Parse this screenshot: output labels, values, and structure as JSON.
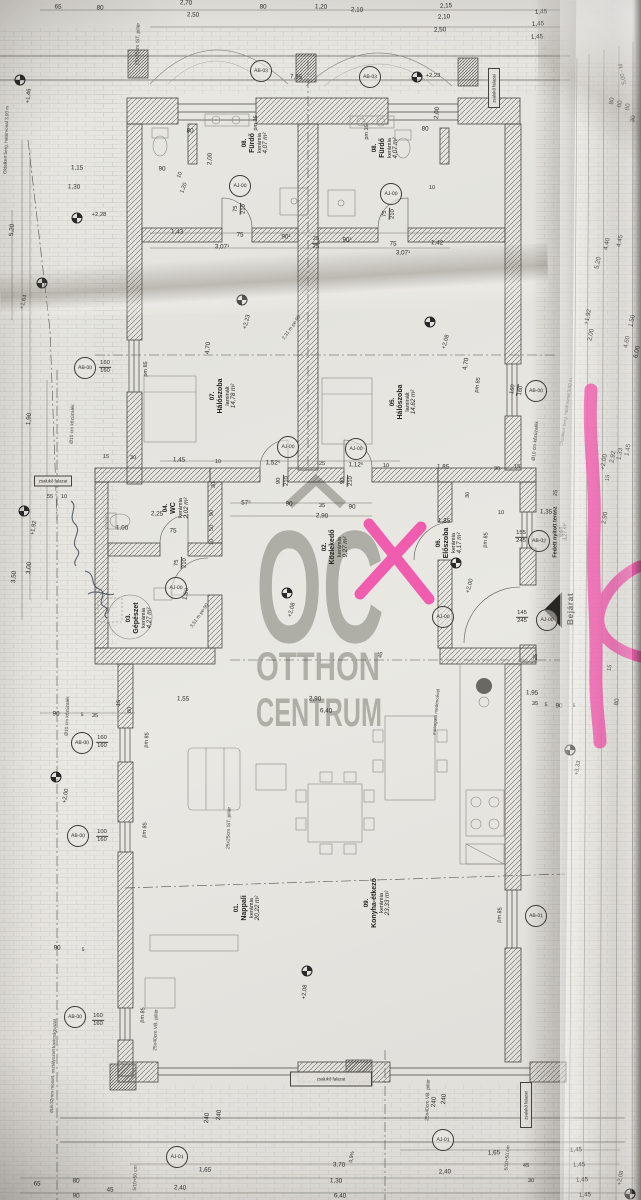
{
  "watermark": {
    "word": "OC",
    "line2": "OTTHON",
    "line3": "CENTRUM",
    "color": "#86867f",
    "roof": "roof-icon"
  },
  "marker": {
    "color": "#f23fa4"
  },
  "pen": {
    "color": "#39414f"
  },
  "entrance": {
    "label": "Bejárat"
  },
  "rooms": [
    {
      "num": "08.",
      "name": "Fürdő",
      "fin": "kerámia",
      "area": "4,07 m²",
      "x": 256,
      "y": 143
    },
    {
      "num": "08.",
      "name": "Fürdő",
      "fin": "kerámia",
      "area": "4,07 m²",
      "x": 386,
      "y": 148
    },
    {
      "num": "07.",
      "name": "Hálószoba",
      "fin": "laminált",
      "area": "14,78 m²",
      "x": 224,
      "y": 396
    },
    {
      "num": "05.",
      "name": "Hálószoba",
      "fin": "laminált",
      "area": "14,62 m²",
      "x": 404,
      "y": 402
    },
    {
      "num": "04.",
      "name": "WC",
      "fin": "kerámia",
      "area": "2,02 m²",
      "x": 177,
      "y": 508
    },
    {
      "num": "03.",
      "name": "Gépészet",
      "fin": "kerámia",
      "area": "4,27 m²",
      "x": 140,
      "y": 618
    },
    {
      "num": "02.",
      "name": "Közlekedő",
      "fin": "kerámia",
      "area": "9,27 m²",
      "x": 336,
      "y": 547
    },
    {
      "num": "06.",
      "name": "Előszoba",
      "fin": "kerámia",
      "area": "4,17 m²",
      "x": 450,
      "y": 543
    },
    {
      "num": "01.",
      "name": "Nappali",
      "fin": "kerámia",
      "area": "20,22 m²",
      "x": 248,
      "y": 908
    },
    {
      "num": "09.",
      "name": "Konyha-étkező",
      "fin": "kerámia",
      "area": "23,33 m²",
      "x": 378,
      "y": 903
    },
    {
      "num": "",
      "name": "Fedett nyitott terasz",
      "fin": "térkő",
      "area": "3,27 m²",
      "x": 561,
      "y": 532,
      "small": true
    }
  ],
  "tags": [
    {
      "t": "AB-03",
      "x": 261,
      "y": 71
    },
    {
      "t": "AB-03",
      "x": 370,
      "y": 77
    },
    {
      "t": "AJ-00",
      "x": 240,
      "y": 186
    },
    {
      "t": "AJ-00",
      "x": 391,
      "y": 194
    },
    {
      "t": "AB-00",
      "x": 85,
      "y": 368
    },
    {
      "t": "AJ-00",
      "x": 288,
      "y": 447
    },
    {
      "t": "AJ-00",
      "x": 356,
      "y": 449
    },
    {
      "t": "AJ-00",
      "x": 176,
      "y": 588
    },
    {
      "t": "AB-00",
      "x": 536,
      "y": 391
    },
    {
      "t": "AB-02",
      "x": 539,
      "y": 541
    },
    {
      "t": "AJ-00",
      "x": 443,
      "y": 617
    },
    {
      "t": "AJ-00",
      "x": 547,
      "y": 620
    },
    {
      "t": "AB-00",
      "x": 82,
      "y": 743
    },
    {
      "t": "AB-00",
      "x": 78,
      "y": 836
    },
    {
      "t": "AB-00",
      "x": 75,
      "y": 1017
    },
    {
      "t": "AB-01",
      "x": 536,
      "y": 916
    },
    {
      "t": "AJ-01",
      "x": 177,
      "y": 1157
    },
    {
      "t": "AJ-01",
      "x": 443,
      "y": 1140
    }
  ],
  "stacks": [
    {
      "a": "160",
      "b": "160",
      "x": 105,
      "y": 367
    },
    {
      "a": "160",
      "b": "160",
      "x": 102,
      "y": 742
    },
    {
      "a": "100",
      "b": "160",
      "x": 102,
      "y": 836
    },
    {
      "a": "160",
      "b": "160",
      "x": 98,
      "y": 1020
    },
    {
      "a": "160",
      "b": "160",
      "x": 517,
      "y": 390,
      "r": -80
    },
    {
      "a": "75",
      "b": "210",
      "x": 240,
      "y": 209,
      "r": -88
    },
    {
      "a": "75",
      "b": "210",
      "x": 389,
      "y": 214,
      "r": -88
    },
    {
      "a": "90",
      "b": "210",
      "x": 283,
      "y": 481,
      "r": -88
    },
    {
      "a": "90",
      "b": "210",
      "x": 347,
      "y": 481,
      "r": -88
    },
    {
      "a": "75",
      "b": "210",
      "x": 181,
      "y": 563,
      "r": -88
    },
    {
      "a": "25",
      "b": "25",
      "x": 316,
      "y": 243
    },
    {
      "a": "155",
      "b": "245",
      "x": 521,
      "y": 537
    },
    {
      "a": "145",
      "b": "245",
      "x": 522,
      "y": 617
    }
  ],
  "levels": [
    {
      "t": "+2,23",
      "x": 417,
      "y": 77,
      "tx": 433,
      "ty": 76,
      "r": 0
    },
    {
      "t": "+2,28",
      "x": 77,
      "y": 218,
      "tx": 99,
      "ty": 215,
      "r": 0
    },
    {
      "t": "+1,46",
      "x": 20,
      "y": 80,
      "tx": 29,
      "ty": 96,
      "r": -85
    },
    {
      "t": "+1,64",
      "x": 42,
      "y": 283,
      "tx": 24,
      "ty": 302,
      "r": -75
    },
    {
      "t": "+2,23",
      "x": 242,
      "y": 300,
      "tx": 247,
      "ty": 322,
      "r": -75
    },
    {
      "t": "+2,08",
      "x": 430,
      "y": 322,
      "tx": 446,
      "ty": 342,
      "r": -75
    },
    {
      "t": "+2,08",
      "x": 287,
      "y": 593,
      "tx": 292,
      "ty": 610,
      "r": -75
    },
    {
      "t": "+2,00",
      "x": 456,
      "y": 563,
      "tx": 470,
      "ty": 586,
      "r": -75
    },
    {
      "t": "+1,92",
      "x": 24,
      "y": 511,
      "tx": 34,
      "ty": 528,
      "r": -80
    },
    {
      "t": "+2,00",
      "x": 56,
      "y": 777,
      "tx": 66,
      "ty": 796,
      "r": -80
    },
    {
      "t": "+2,08",
      "x": 307,
      "y": 971,
      "tx": 305,
      "ty": 992,
      "r": -85
    },
    {
      "t": "+3,33",
      "x": 570,
      "y": 750,
      "tx": 578,
      "ty": 768,
      "r": -80
    },
    {
      "t": "+2,08",
      "x": 630,
      "y": 1194,
      "tx": 621,
      "ty": 1178,
      "r": -80
    }
  ],
  "dims": [
    {
      "t": "2,70",
      "x": 186,
      "y": 3
    },
    {
      "t": "65",
      "x": 58,
      "y": 7
    },
    {
      "t": "80",
      "x": 100,
      "y": 8
    },
    {
      "t": "2,50",
      "x": 193,
      "y": 15
    },
    {
      "t": "80",
      "x": 263,
      "y": 7
    },
    {
      "t": "1,20",
      "x": 321,
      "y": 7
    },
    {
      "t": "2,10",
      "x": 357,
      "y": 10
    },
    {
      "t": "2,15",
      "x": 446,
      "y": 6,
      "r": -3
    },
    {
      "t": "2,10",
      "x": 444,
      "y": 17,
      "r": -3
    },
    {
      "t": "2,50",
      "x": 440,
      "y": 30,
      "r": -3
    },
    {
      "t": "1,45",
      "x": 541,
      "y": 12,
      "r": -3
    },
    {
      "t": "1,45",
      "x": 538,
      "y": 24,
      "r": -3
    },
    {
      "t": "1,45",
      "x": 537,
      "y": 37,
      "r": -3
    },
    {
      "t": "5,00 - M",
      "x": 623,
      "y": 74,
      "r": -100,
      "s": 5.8
    },
    {
      "t": "80",
      "x": 612,
      "y": 101,
      "r": -80
    },
    {
      "t": "80",
      "x": 620,
      "y": 104,
      "r": -80
    },
    {
      "t": "80",
      "x": 628,
      "y": 107,
      "r": -80
    },
    {
      "t": "30",
      "x": 633,
      "y": 119,
      "r": -80
    },
    {
      "t": "7,85",
      "x": 296,
      "y": 77
    },
    {
      "t": "1,15",
      "x": 77,
      "y": 168
    },
    {
      "t": "1,30",
      "x": 74,
      "y": 187
    },
    {
      "t": "5,20",
      "x": 12,
      "y": 230,
      "r": -85
    },
    {
      "t": "90",
      "x": 162,
      "y": 169
    },
    {
      "t": "10",
      "x": 180,
      "y": 175,
      "r": -70,
      "s": 5.5
    },
    {
      "t": "1,20",
      "x": 184,
      "y": 188,
      "r": -70,
      "s": 5.5
    },
    {
      "t": "80",
      "x": 190,
      "y": 131
    },
    {
      "t": "80",
      "x": 425,
      "y": 129
    },
    {
      "t": "2,00",
      "x": 210,
      "y": 159,
      "r": -88
    },
    {
      "t": "2,00",
      "x": 437,
      "y": 113,
      "r": -85
    },
    {
      "t": "10",
      "x": 432,
      "y": 188,
      "s": 5.5
    },
    {
      "t": "pm 35",
      "x": 256,
      "y": 123,
      "r": -88,
      "s": 5.5
    },
    {
      "t": "pm 35",
      "x": 367,
      "y": 132,
      "r": -88,
      "s": 5.5
    },
    {
      "t": "1,43",
      "x": 177,
      "y": 232
    },
    {
      "t": "75",
      "x": 240,
      "y": 235
    },
    {
      "t": "90¹",
      "x": 286,
      "y": 237
    },
    {
      "t": "90¹",
      "x": 347,
      "y": 240
    },
    {
      "t": "75",
      "x": 393,
      "y": 244
    },
    {
      "t": "1,42",
      "x": 437,
      "y": 243
    },
    {
      "t": "3,07¹",
      "x": 222,
      "y": 247
    },
    {
      "t": "3,07¹",
      "x": 403,
      "y": 253
    },
    {
      "t": "4,70",
      "x": 208,
      "y": 348,
      "r": -85
    },
    {
      "t": "4,70",
      "x": 466,
      "y": 364,
      "r": -80
    },
    {
      "t": "pm 85",
      "x": 146,
      "y": 369,
      "r": -88,
      "s": 5.5
    },
    {
      "t": "pm 85",
      "x": 478,
      "y": 385,
      "r": -82,
      "s": 5.5
    },
    {
      "t": "1,45",
      "x": 179,
      "y": 460
    },
    {
      "t": "10",
      "x": 218,
      "y": 462,
      "s": 5.5
    },
    {
      "t": "1,52⁵",
      "x": 273,
      "y": 463
    },
    {
      "t": "25",
      "x": 322,
      "y": 464,
      "s": 5.5
    },
    {
      "t": "1,12⁵",
      "x": 356,
      "y": 465
    },
    {
      "t": "10",
      "x": 386,
      "y": 466,
      "s": 5.5
    },
    {
      "t": "15",
      "x": 106,
      "y": 457,
      "s": 5.5
    },
    {
      "t": "30",
      "x": 133,
      "y": 458,
      "s": 5.5
    },
    {
      "t": "55",
      "x": 50,
      "y": 497,
      "s": 5.5
    },
    {
      "t": "10",
      "x": 64,
      "y": 497,
      "s": 5.5
    },
    {
      "t": "30",
      "x": 214,
      "y": 485,
      "r": -85,
      "s": 5.5
    },
    {
      "t": "57⁵",
      "x": 246,
      "y": 503
    },
    {
      "t": "90",
      "x": 289,
      "y": 504
    },
    {
      "t": "35",
      "x": 322,
      "y": 506,
      "s": 5.5
    },
    {
      "t": "90",
      "x": 352,
      "y": 507
    },
    {
      "t": "2,90",
      "x": 322,
      "y": 516
    },
    {
      "t": "1,85",
      "x": 443,
      "y": 467
    },
    {
      "t": "1,85",
      "x": 444,
      "y": 521
    },
    {
      "t": "30",
      "x": 497,
      "y": 469,
      "s": 5.5
    },
    {
      "t": "15",
      "x": 517,
      "y": 467,
      "s": 5.5
    },
    {
      "t": "30",
      "x": 468,
      "y": 495,
      "r": -85,
      "s": 5.5
    },
    {
      "t": "10",
      "x": 501,
      "y": 513,
      "s": 5.5
    },
    {
      "t": "1,35",
      "x": 546,
      "y": 512
    },
    {
      "t": "2,25",
      "x": 157,
      "y": 514
    },
    {
      "t": "1,00",
      "x": 122,
      "y": 528
    },
    {
      "t": "75",
      "x": 173,
      "y": 531
    },
    {
      "t": "90",
      "x": 212,
      "y": 513,
      "r": -85,
      "s": 5.5
    },
    {
      "t": "50",
      "x": 212,
      "y": 528,
      "r": -85,
      "s": 5.5
    },
    {
      "t": "10",
      "x": 212,
      "y": 542,
      "r": -85,
      "s": 5.5
    },
    {
      "t": "1,90",
      "x": 186,
      "y": 594,
      "r": -80
    },
    {
      "t": "1,90",
      "x": 29,
      "y": 419,
      "r": -85
    },
    {
      "t": "3,00",
      "x": 29,
      "y": 568,
      "r": -85
    },
    {
      "t": "3,50",
      "x": 14,
      "y": 577,
      "r": -85
    },
    {
      "t": "2,90",
      "x": 605,
      "y": 518,
      "r": -80
    },
    {
      "t": "25",
      "x": 556,
      "y": 493,
      "r": -80,
      "s": 5.5
    },
    {
      "t": "pm 85",
      "x": 486,
      "y": 540,
      "r": -85,
      "s": 5.5
    },
    {
      "t": "4,45",
      "x": 620,
      "y": 241,
      "r": -78
    },
    {
      "t": "4,40",
      "x": 607,
      "y": 244,
      "r": -78
    },
    {
      "t": "5,20",
      "x": 598,
      "y": 263,
      "r": -78
    },
    {
      "t": "+1,92",
      "x": 588,
      "y": 317,
      "r": -78
    },
    {
      "t": "2,00",
      "x": 591,
      "y": 335,
      "r": -78
    },
    {
      "t": "1,50",
      "x": 632,
      "y": 321,
      "r": -78
    },
    {
      "t": "4,60",
      "x": 627,
      "y": 342,
      "r": -78
    },
    {
      "t": "6,00",
      "x": 637,
      "y": 352,
      "r": -78
    },
    {
      "t": "2,92",
      "x": 613,
      "y": 457,
      "r": -80
    },
    {
      "t": "1,33",
      "x": 620,
      "y": 454,
      "r": -80
    },
    {
      "t": "1,45",
      "x": 628,
      "y": 450,
      "r": -80
    },
    {
      "t": "+2,00",
      "x": 604,
      "y": 462,
      "r": -80
    },
    {
      "t": "15",
      "x": 608,
      "y": 478,
      "r": -80,
      "s": 5.5
    },
    {
      "t": "15",
      "x": 610,
      "y": 668,
      "r": -80,
      "s": 5.5
    },
    {
      "t": "35",
      "x": 535,
      "y": 704,
      "s": 5.5
    },
    {
      "t": "5",
      "x": 546,
      "y": 705,
      "s": 5
    },
    {
      "t": "90",
      "x": 559,
      "y": 706
    },
    {
      "t": "5",
      "x": 574,
      "y": 706,
      "s": 5
    },
    {
      "t": "80",
      "x": 617,
      "y": 702,
      "r": -80
    },
    {
      "t": "1,95",
      "x": 532,
      "y": 693
    },
    {
      "t": "1,55",
      "x": 183,
      "y": 699
    },
    {
      "t": "90",
      "x": 56,
      "y": 714
    },
    {
      "t": "5",
      "x": 82,
      "y": 715,
      "s": 5
    },
    {
      "t": "35",
      "x": 95,
      "y": 716,
      "s": 5.5
    },
    {
      "t": "15",
      "x": 119,
      "y": 703,
      "r": -85,
      "s": 5.5
    },
    {
      "t": "80",
      "x": 130,
      "y": 710,
      "r": -85,
      "s": 5.5
    },
    {
      "t": "45",
      "x": 381,
      "y": 655,
      "r": -80,
      "s": 5.5
    },
    {
      "t": "25",
      "x": 536,
      "y": 657,
      "r": -85,
      "s": 5.5
    },
    {
      "t": "2,90",
      "x": 315,
      "y": 699
    },
    {
      "t": "6,40",
      "x": 326,
      "y": 711
    },
    {
      "t": "90",
      "x": 57,
      "y": 948
    },
    {
      "t": "5",
      "x": 83,
      "y": 950,
      "s": 5
    },
    {
      "t": "65",
      "x": 37,
      "y": 1184
    },
    {
      "t": "80",
      "x": 76,
      "y": 1181
    },
    {
      "t": "90",
      "x": 76,
      "y": 1196
    },
    {
      "t": "45",
      "x": 110,
      "y": 1190
    },
    {
      "t": "1,65",
      "x": 205,
      "y": 1170
    },
    {
      "t": "2,40",
      "x": 180,
      "y": 1188
    },
    {
      "t": "3,70",
      "x": 339,
      "y": 1165
    },
    {
      "t": "1,30",
      "x": 336,
      "y": 1181
    },
    {
      "t": "6,40",
      "x": 340,
      "y": 1196
    },
    {
      "t": "1,65",
      "x": 494,
      "y": 1153,
      "r": -2
    },
    {
      "t": "2,40",
      "x": 445,
      "y": 1172,
      "r": -2
    },
    {
      "t": "45",
      "x": 526,
      "y": 1166,
      "s": 5.5
    },
    {
      "t": "30",
      "x": 531,
      "y": 1181,
      "s": 5.5
    },
    {
      "t": "1,45",
      "x": 576,
      "y": 1150,
      "r": -3
    },
    {
      "t": "1,45",
      "x": 579,
      "y": 1165,
      "r": -3
    },
    {
      "t": "1,45",
      "x": 582,
      "y": 1180,
      "r": -3
    },
    {
      "t": "1,45",
      "x": 585,
      "y": 1195,
      "r": -3
    },
    {
      "t": "240",
      "x": 434,
      "y": 1102,
      "r": -85
    },
    {
      "t": "240",
      "x": 444,
      "y": 1099,
      "r": -85
    },
    {
      "t": "240",
      "x": 207,
      "y": 1118,
      "r": -85
    },
    {
      "t": "240",
      "x": 219,
      "y": 1115,
      "r": -85
    },
    {
      "t": "0,5%",
      "x": 352,
      "y": 1157,
      "r": -80,
      "s": 5
    },
    {
      "t": "pm 85",
      "x": 147,
      "y": 740,
      "r": -85,
      "s": 5.5
    },
    {
      "t": "pm 85",
      "x": 145,
      "y": 830,
      "r": -85,
      "s": 5.5
    },
    {
      "t": "pm 85",
      "x": 143,
      "y": 1015,
      "r": -85,
      "s": 5.5
    },
    {
      "t": "pm 85",
      "x": 500,
      "y": 915,
      "r": -85,
      "s": 5.5
    }
  ],
  "notes": [
    {
      "t": "25x25cm IST. pillér",
      "x": 138,
      "y": 44,
      "r": -88,
      "s": 5
    },
    {
      "t": "25x25cm IST. pillér",
      "x": 229,
      "y": 828,
      "r": -88,
      "s": 5
    },
    {
      "t": "25x40cm VB. pillér",
      "x": 156,
      "y": 1030,
      "r": -88,
      "s": 5
    },
    {
      "t": "25x40cm VB. pillér",
      "x": 428,
      "y": 1100,
      "r": -88,
      "s": 5
    },
    {
      "t": "Ø10 cm kőzúzalék",
      "x": 73,
      "y": 424,
      "r": -88,
      "s": 4.8
    },
    {
      "t": "Ø10 cm kőzúzalék",
      "x": 68,
      "y": 716,
      "r": -88,
      "s": 4.8
    },
    {
      "t": "Ø10 cm kőzúzalék",
      "x": 536,
      "y": 441,
      "r": -85,
      "s": 4.8
    },
    {
      "t": "mosogató medencével",
      "x": 436,
      "y": 712,
      "r": -85,
      "s": 4.6
    },
    {
      "t": "d16-32mm mosott, osztályozott kavicságyazat",
      "x": 53,
      "y": 1066,
      "r": -88,
      "s": 4.6
    },
    {
      "t": "Oldalkert berg. határvonal 3,00 m",
      "x": 6,
      "y": 140,
      "r": -88,
      "s": 4.6
    },
    {
      "t": "Oldalkert berg. határvonal 3,00 m",
      "x": 566,
      "y": 412,
      "r": -82,
      "s": 4.6
    },
    {
      "t": "5/10+50 cm",
      "x": 136,
      "y": 1178,
      "r": -88,
      "s": 4.8
    },
    {
      "t": "5/10+50 cm",
      "x": 508,
      "y": 1158,
      "r": -85,
      "s": 4.8
    },
    {
      "t": "2,31 m pe-90",
      "x": 292,
      "y": 328,
      "r": -55,
      "s": 4.8
    },
    {
      "t": "3,51 m pe-90",
      "x": 200,
      "y": 616,
      "r": -55,
      "s": 4.8
    }
  ],
  "boxes": [
    {
      "t": "zsalukő falazat",
      "x": 53,
      "y": 481,
      "w": 36,
      "h": 9
    },
    {
      "t": "zsalukő falazat",
      "x": 494,
      "y": 88,
      "w": 10,
      "h": 38,
      "vert": true
    },
    {
      "t": "zsalukő falazat",
      "x": 526,
      "y": 1105,
      "w": 10,
      "h": 44,
      "vert": true
    },
    {
      "t": "zsalukő falazat",
      "x": 331,
      "y": 1079,
      "w": 80,
      "h": 13
    }
  ]
}
